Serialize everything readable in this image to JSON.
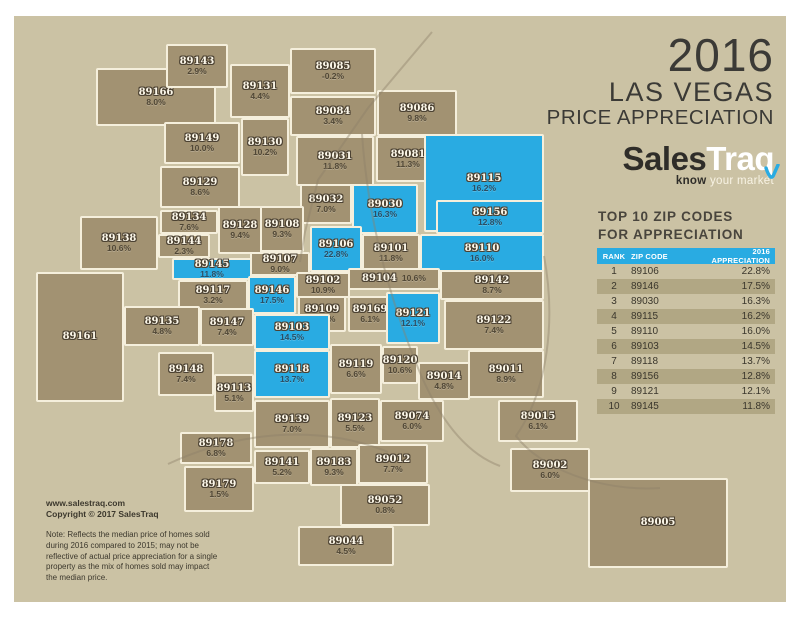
{
  "title": {
    "year": "2016",
    "line1": "LAS VEGAS",
    "line2": "PRICE APPRECIATION"
  },
  "logo": {
    "part1": "Sales",
    "part2": "Traq",
    "tagline_bold": "know",
    "tagline_rest": " your market"
  },
  "table": {
    "heading_line1": "TOP 10 ZIP CODES",
    "heading_line2": "FOR APPRECIATION",
    "columns": [
      "RANK",
      "ZIP CODE",
      "2016 APPRECIATION"
    ],
    "rows": [
      {
        "rank": "1",
        "zip": "89106",
        "appreciation": "22.8%"
      },
      {
        "rank": "2",
        "zip": "89146",
        "appreciation": "17.5%"
      },
      {
        "rank": "3",
        "zip": "89030",
        "appreciation": "16.3%"
      },
      {
        "rank": "4",
        "zip": "89115",
        "appreciation": "16.2%"
      },
      {
        "rank": "5",
        "zip": "89110",
        "appreciation": "16.0%"
      },
      {
        "rank": "6",
        "zip": "89103",
        "appreciation": "14.5%"
      },
      {
        "rank": "7",
        "zip": "89118",
        "appreciation": "13.7%"
      },
      {
        "rank": "8",
        "zip": "89156",
        "appreciation": "12.8%"
      },
      {
        "rank": "9",
        "zip": "89121",
        "appreciation": "12.1%"
      },
      {
        "rank": "10",
        "zip": "89145",
        "appreciation": "11.8%"
      }
    ]
  },
  "footer": {
    "website": "www.salestraq.com",
    "copyright": "Copyright © 2017 SalesTraq",
    "note": "Note: Reflects the median price of homes sold during 2016 compared to 2015; may not be reflective of actual price appreciation for a single property as the mix of homes sold may impact the median price."
  },
  "colors": {
    "canvas": "#cbc2a4",
    "region_fill": "#a29272",
    "region_border": "#f5efdc",
    "highlight_blue": "#29abe2",
    "title_text": "#3b3a36",
    "table_stripe": "#b1a784"
  },
  "map": {
    "regions": [
      {
        "zip": "89166",
        "pct": "8.0%",
        "x": 96,
        "y": 68,
        "w": 120,
        "h": 58,
        "blue": false
      },
      {
        "zip": "89143",
        "pct": "2.9%",
        "x": 166,
        "y": 44,
        "w": 62,
        "h": 44,
        "blue": false
      },
      {
        "zip": "89131",
        "pct": "4.4%",
        "x": 230,
        "y": 64,
        "w": 60,
        "h": 54,
        "blue": false
      },
      {
        "zip": "89085",
        "pct": "-0.2%",
        "x": 290,
        "y": 48,
        "w": 86,
        "h": 46,
        "blue": false
      },
      {
        "zip": "89084",
        "pct": "3.4%",
        "x": 290,
        "y": 96,
        "w": 86,
        "h": 40,
        "blue": false
      },
      {
        "zip": "89086",
        "pct": "9.8%",
        "x": 377,
        "y": 90,
        "w": 80,
        "h": 46,
        "blue": false
      },
      {
        "zip": "89149",
        "pct": "10.0%",
        "x": 164,
        "y": 122,
        "w": 76,
        "h": 42,
        "blue": false
      },
      {
        "zip": "89130",
        "pct": "10.2%",
        "x": 241,
        "y": 118,
        "w": 48,
        "h": 58,
        "blue": false
      },
      {
        "zip": "89031",
        "pct": "11.8%",
        "x": 296,
        "y": 136,
        "w": 78,
        "h": 50,
        "blue": false
      },
      {
        "zip": "89081",
        "pct": "11.3%",
        "x": 376,
        "y": 136,
        "w": 64,
        "h": 46,
        "blue": false
      },
      {
        "zip": "89115",
        "pct": "16.2%",
        "x": 424,
        "y": 134,
        "w": 120,
        "h": 98,
        "blue": true
      },
      {
        "zip": "89129",
        "pct": "8.6%",
        "x": 160,
        "y": 166,
        "w": 80,
        "h": 42,
        "blue": false
      },
      {
        "zip": "89032",
        "pct": "7.0%",
        "x": 300,
        "y": 184,
        "w": 52,
        "h": 40,
        "blue": false
      },
      {
        "zip": "89030",
        "pct": "16.3%",
        "x": 352,
        "y": 184,
        "w": 66,
        "h": 50,
        "blue": true
      },
      {
        "zip": "89156",
        "pct": "12.8%",
        "x": 436,
        "y": 200,
        "w": 108,
        "h": 34,
        "blue": true
      },
      {
        "zip": "89134",
        "pct": "7.6%",
        "x": 160,
        "y": 210,
        "w": 58,
        "h": 24,
        "blue": false
      },
      {
        "zip": "89128",
        "pct": "9.4%",
        "x": 218,
        "y": 206,
        "w": 44,
        "h": 48,
        "blue": false
      },
      {
        "zip": "89108",
        "pct": "9.3%",
        "x": 260,
        "y": 206,
        "w": 44,
        "h": 46,
        "blue": false
      },
      {
        "zip": "89138",
        "pct": "10.6%",
        "x": 80,
        "y": 216,
        "w": 78,
        "h": 54,
        "blue": false
      },
      {
        "zip": "89161",
        "pct": "",
        "x": 36,
        "y": 272,
        "w": 88,
        "h": 130,
        "blue": false
      },
      {
        "zip": "89144",
        "pct": "2.3%",
        "x": 158,
        "y": 234,
        "w": 52,
        "h": 24,
        "blue": false
      },
      {
        "zip": "89145",
        "pct": "11.8%",
        "x": 172,
        "y": 258,
        "w": 80,
        "h": 22,
        "blue": true
      },
      {
        "zip": "89107",
        "pct": "9.0%",
        "x": 250,
        "y": 252,
        "w": 60,
        "h": 24,
        "blue": false
      },
      {
        "zip": "89106",
        "pct": "22.8%",
        "x": 310,
        "y": 226,
        "w": 52,
        "h": 46,
        "blue": true
      },
      {
        "zip": "89101",
        "pct": "11.8%",
        "x": 362,
        "y": 234,
        "w": 58,
        "h": 38,
        "blue": false
      },
      {
        "zip": "89110",
        "pct": "16.0%",
        "x": 420,
        "y": 234,
        "w": 124,
        "h": 38,
        "blue": true
      },
      {
        "zip": "89117",
        "pct": "3.2%",
        "x": 178,
        "y": 280,
        "w": 70,
        "h": 30,
        "blue": false
      },
      {
        "zip": "89146",
        "pct": "17.5%",
        "x": 248,
        "y": 276,
        "w": 48,
        "h": 38,
        "blue": true
      },
      {
        "zip": "89102",
        "pct": "10.9%",
        "x": 296,
        "y": 272,
        "w": 54,
        "h": 26,
        "blue": false
      },
      {
        "zip": "89104",
        "pct": "10.6%",
        "x": 348,
        "y": 268,
        "w": 92,
        "h": 22,
        "blue": false,
        "inline": true
      },
      {
        "zip": "89142",
        "pct": "8.7%",
        "x": 440,
        "y": 270,
        "w": 104,
        "h": 30,
        "blue": false
      },
      {
        "zip": "89135",
        "pct": "4.8%",
        "x": 124,
        "y": 306,
        "w": 76,
        "h": 40,
        "blue": false
      },
      {
        "zip": "89147",
        "pct": "7.4%",
        "x": 200,
        "y": 308,
        "w": 54,
        "h": 38,
        "blue": false
      },
      {
        "zip": "89109",
        "pct": "-12.1%",
        "x": 298,
        "y": 296,
        "w": 48,
        "h": 36,
        "blue": false
      },
      {
        "zip": "89169",
        "pct": "6.1%",
        "x": 348,
        "y": 296,
        "w": 44,
        "h": 36,
        "blue": false
      },
      {
        "zip": "89121",
        "pct": "12.1%",
        "x": 386,
        "y": 292,
        "w": 54,
        "h": 52,
        "blue": true
      },
      {
        "zip": "89122",
        "pct": "7.4%",
        "x": 444,
        "y": 300,
        "w": 100,
        "h": 50,
        "blue": false
      },
      {
        "zip": "89103",
        "pct": "14.5%",
        "x": 254,
        "y": 314,
        "w": 76,
        "h": 36,
        "blue": true
      },
      {
        "zip": "89120",
        "pct": "10.6%",
        "x": 382,
        "y": 346,
        "w": 36,
        "h": 38,
        "blue": false
      },
      {
        "zip": "89118",
        "pct": "13.7%",
        "x": 254,
        "y": 350,
        "w": 76,
        "h": 48,
        "blue": true
      },
      {
        "zip": "89119",
        "pct": "6.6%",
        "x": 330,
        "y": 344,
        "w": 52,
        "h": 50,
        "blue": false
      },
      {
        "zip": "89014",
        "pct": "4.8%",
        "x": 418,
        "y": 362,
        "w": 52,
        "h": 38,
        "blue": false
      },
      {
        "zip": "89011",
        "pct": "8.9%",
        "x": 468,
        "y": 350,
        "w": 76,
        "h": 48,
        "blue": false
      },
      {
        "zip": "89148",
        "pct": "7.4%",
        "x": 158,
        "y": 352,
        "w": 56,
        "h": 44,
        "blue": false
      },
      {
        "zip": "89113",
        "pct": "5.1%",
        "x": 214,
        "y": 374,
        "w": 40,
        "h": 38,
        "blue": false
      },
      {
        "zip": "89074",
        "pct": "6.0%",
        "x": 380,
        "y": 400,
        "w": 64,
        "h": 42,
        "blue": false
      },
      {
        "zip": "89015",
        "pct": "6.1%",
        "x": 498,
        "y": 400,
        "w": 80,
        "h": 42,
        "blue": false
      },
      {
        "zip": "89139",
        "pct": "7.0%",
        "x": 254,
        "y": 400,
        "w": 76,
        "h": 48,
        "blue": false
      },
      {
        "zip": "89123",
        "pct": "5.5%",
        "x": 330,
        "y": 398,
        "w": 50,
        "h": 50,
        "blue": false
      },
      {
        "zip": "89178",
        "pct": "6.8%",
        "x": 180,
        "y": 432,
        "w": 72,
        "h": 32,
        "blue": false
      },
      {
        "zip": "89141",
        "pct": "5.2%",
        "x": 254,
        "y": 450,
        "w": 56,
        "h": 34,
        "blue": false
      },
      {
        "zip": "89183",
        "pct": "9.3%",
        "x": 310,
        "y": 448,
        "w": 48,
        "h": 38,
        "blue": false
      },
      {
        "zip": "89012",
        "pct": "7.7%",
        "x": 358,
        "y": 444,
        "w": 70,
        "h": 40,
        "blue": false
      },
      {
        "zip": "89002",
        "pct": "6.0%",
        "x": 510,
        "y": 448,
        "w": 80,
        "h": 44,
        "blue": false
      },
      {
        "zip": "89179",
        "pct": "1.5%",
        "x": 184,
        "y": 466,
        "w": 70,
        "h": 46,
        "blue": false
      },
      {
        "zip": "89052",
        "pct": "0.8%",
        "x": 340,
        "y": 484,
        "w": 90,
        "h": 42,
        "blue": false
      },
      {
        "zip": "89044",
        "pct": "4.5%",
        "x": 298,
        "y": 526,
        "w": 96,
        "h": 40,
        "blue": false
      },
      {
        "zip": "89005",
        "pct": "",
        "x": 588,
        "y": 478,
        "w": 140,
        "h": 90,
        "blue": false
      }
    ]
  }
}
